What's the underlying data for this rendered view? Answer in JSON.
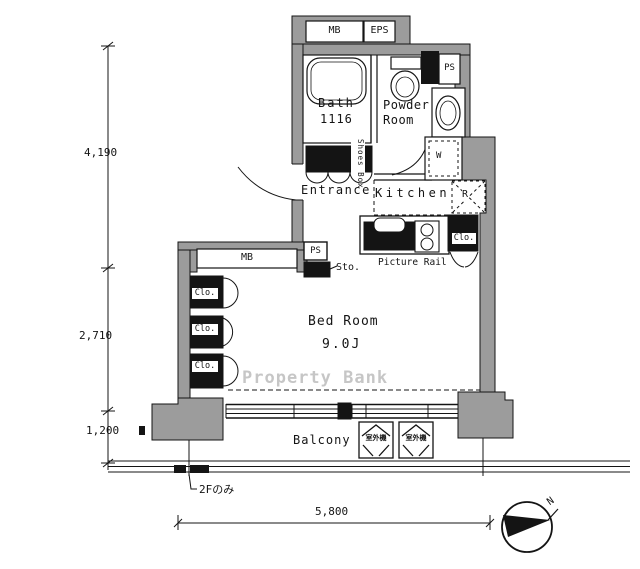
{
  "floorplan": {
    "rooms": {
      "bath": {
        "label": "Bath",
        "size": "1116"
      },
      "powder_room": {
        "line1": "Powder",
        "line2": "Room"
      },
      "kitchen": {
        "label": "Kitchen"
      },
      "entrance": {
        "label": "Entrance"
      },
      "bedroom": {
        "label": "Bed Room",
        "size": "9.0J"
      },
      "balcony": {
        "label": "Balcony"
      }
    },
    "labels": {
      "meter_box_top": "MB",
      "eps": "EPS",
      "ps_top": "PS",
      "ps_hall": "PS",
      "storage": "Sto.",
      "shoes_box": "Shoes Box",
      "picture_rail": "Picture Rail",
      "refrigerator_space": "R",
      "washer_space": "W",
      "kitchen_closet": "Clo.",
      "bedroom_closet_1": "Clo.",
      "bedroom_closet_2": "Clo.",
      "bedroom_closet_3": "Clo.",
      "bedroom_meter_box": "MB",
      "outdoor_unit_1": "室外機",
      "outdoor_unit_2": "室外機"
    },
    "dimensions": {
      "left_upper": "4,190",
      "left_middle": "2,710",
      "left_lower": "1,200",
      "bottom_width": "5,800"
    },
    "annotations": {
      "floor_note": "2Fのみ",
      "north": "N",
      "watermark": "Property Bank"
    },
    "colors": {
      "wall": "#9c9c9c",
      "line": "#141414",
      "watermark": "#b9b9b9"
    }
  }
}
